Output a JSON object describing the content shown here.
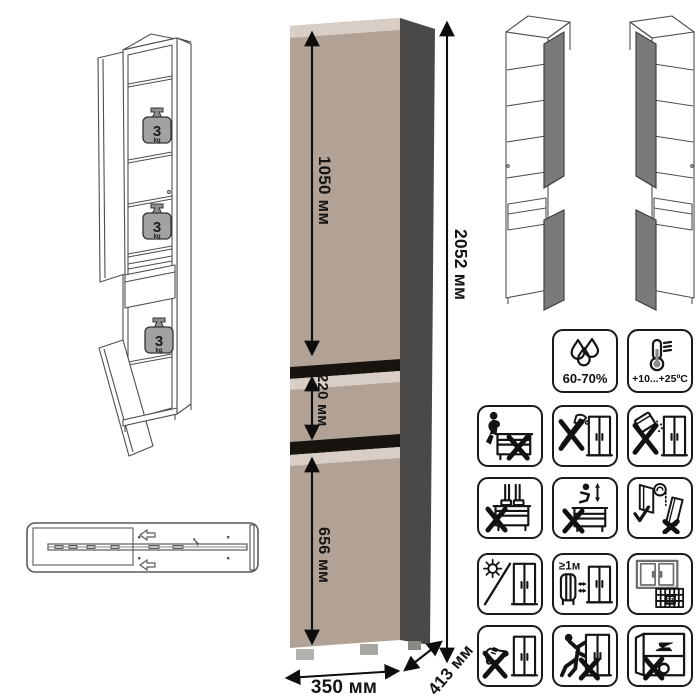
{
  "sheet": {
    "background": "#ffffff"
  },
  "colors": {
    "cabinet_front": "#b2a295",
    "cabinet_front_edge": "#d9cec6",
    "cabinet_side": "#4b4947",
    "cabinet_gap": "#17130f",
    "wireframe_door_fill": "#7b7a78",
    "weight_fill": "#a2a2a0",
    "icon_stroke": "#141414"
  },
  "dimensions": {
    "top_door_height": "1050 мм",
    "total_height": "2052 мм",
    "drawer_height": "220 мм",
    "bottom_door_height": "656 мм",
    "width": "350 мм",
    "depth": "413 мм"
  },
  "shelf_load": {
    "value": "3",
    "unit": "kg"
  },
  "climate": {
    "humidity": {
      "icon": "water-drops-icon",
      "label": "60-70%"
    },
    "temperature": {
      "icon": "thermometer-icon",
      "label": "+10...+25ºC"
    }
  },
  "care_icons": {
    "heater_clearance_label": "≥1м",
    "calendar_day": "21",
    "grid": [
      "no-sitting-icon",
      "no-sharp-tools-icon",
      "no-abrasive-powder-icon",
      "no-standing-icon",
      "no-jumping-icon",
      "door-adjustment-icon",
      "no-direct-sunlight-icon",
      "heater-clearance-icon",
      "room-ventilation-icon",
      "no-shoe-push-icon",
      "no-dragging-icon",
      "no-heavy-items-icon"
    ]
  }
}
